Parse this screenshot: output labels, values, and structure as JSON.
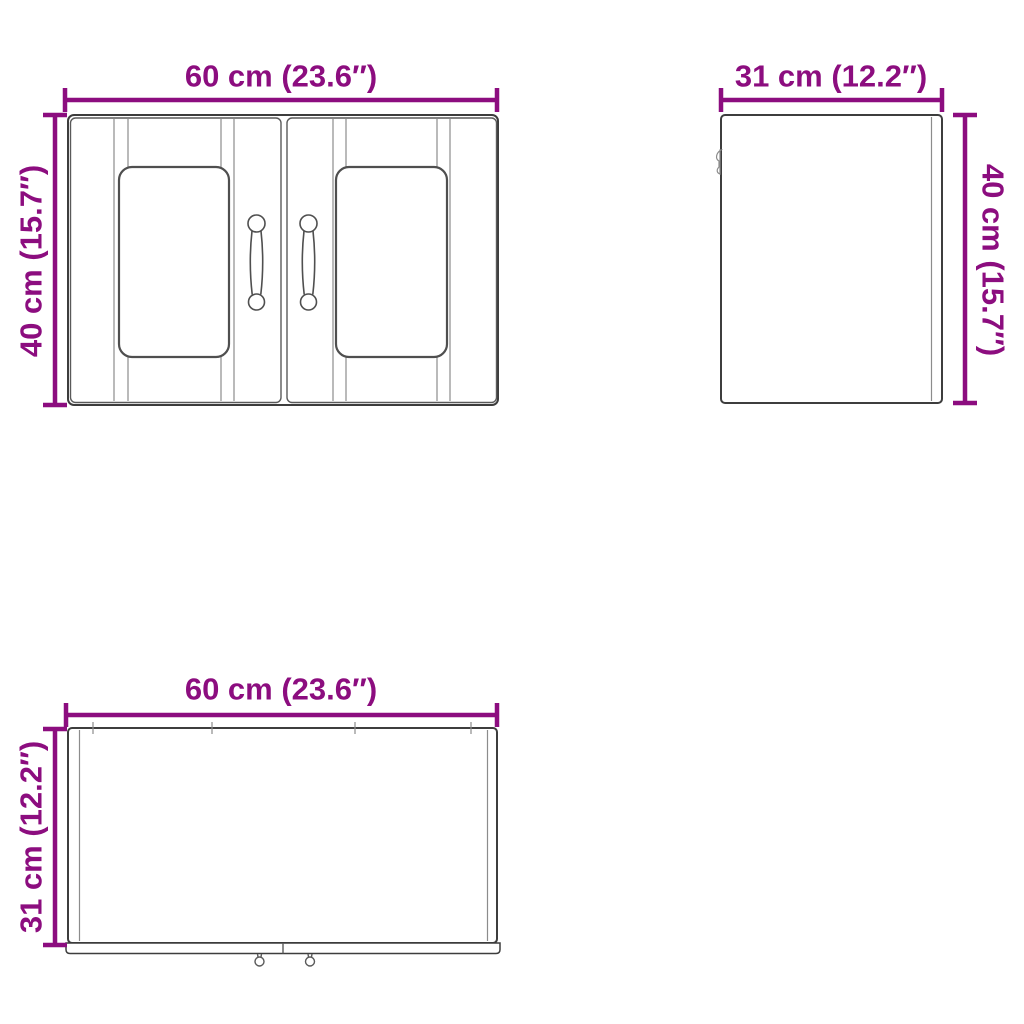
{
  "colors": {
    "accent": "#8C0D7F",
    "line_dark": "#3d3d3d",
    "line_mid": "#5a5a5a",
    "line_light": "#8c8c8c",
    "background": "#ffffff"
  },
  "views": {
    "front": {
      "width_label": "60 cm (23.6″)",
      "height_label": "40 cm (15.7″)"
    },
    "side": {
      "width_label": "31 cm (12.2″)",
      "height_label": "40 cm (15.7″)"
    },
    "top": {
      "width_label": "60 cm (23.6″)",
      "height_label": "31 cm (12.2″)"
    }
  }
}
